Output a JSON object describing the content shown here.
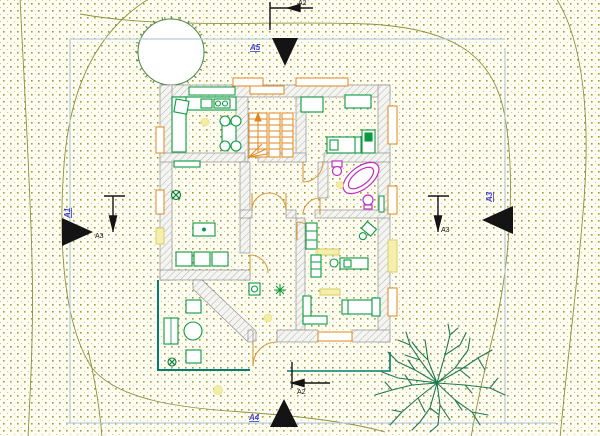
{
  "drawing": {
    "type": "architectural-site-plan-with-floor-plan",
    "markers": {
      "top": {
        "elevation_label": "A5",
        "section_label": "A2"
      },
      "bottom": {
        "elevation_label": "A4",
        "section_label": "A2"
      },
      "left": {
        "elevation_label": "A1",
        "section_label": "A3"
      },
      "right": {
        "elevation_label": "A3",
        "section_label": "A3"
      }
    },
    "colors": {
      "background": "#fffdf2",
      "dot_grid": "#9c9c3a",
      "contour_lines": "#8f8f3c",
      "site_boundary": "#b5cede",
      "wall_hatch": "#b4b4b4",
      "wall_outline": "#909090",
      "furniture_green": "#0a9a3e",
      "terrace_teal": "#00806b",
      "tree_green": "#1e7a4e",
      "sanitary_magenta": "#c22cc2",
      "stairs_orange": "#e0861e",
      "door_tan": "#d99a3e",
      "window_yellow": "#f5efae",
      "light_yellow": "#f2eda0",
      "elevation_text_blue": "#3c3ccc",
      "section_text_black": "#141414"
    }
  }
}
